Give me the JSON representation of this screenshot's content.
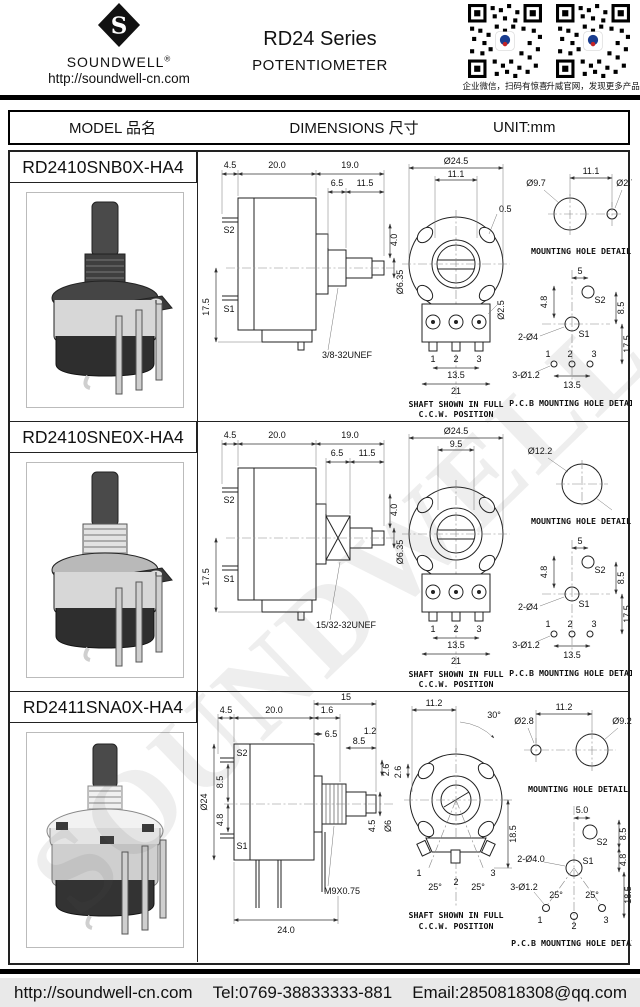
{
  "header": {
    "brand": "SOUNDWELL",
    "reg": "®",
    "site": "http://soundwell-cn.com",
    "title_line1": "RD24 Series",
    "title_line2": "POTENTIOMETER",
    "qr1_caption": "企业微信，扫码有惊喜",
    "qr2_caption": "升威官网，发现更多产品"
  },
  "table_header": {
    "model": "MODEL 品名",
    "dimensions": "DIMENSIONS 尺寸",
    "unit": "UNIT:mm"
  },
  "watermark": "SOUNDWELL",
  "rows": [
    {
      "model": "RD2410SNB0X-HA4",
      "side": {
        "a45": "4.5",
        "a200": "20.0",
        "a190": "19.0",
        "a65": "6.5",
        "a115": "11.5",
        "a40": "4.0",
        "d635": "Ø6.35",
        "s2": "S2",
        "s1": "S1",
        "a175": "17.5",
        "thread": "3/8-32UNEF"
      },
      "front": {
        "dia": "Ø24.5",
        "slot": "11.1",
        "a05": "0.5",
        "d25": "Ø2.5",
        "p1": "1",
        "p2": "2",
        "p3": "3",
        "a135": "13.5",
        "a21": "21",
        "cap1": "SHAFT SHOWN IN FULL",
        "cap2": "C.C.W. POSITION"
      },
      "mount": {
        "d1": "Ø9.7",
        "span": "11.1",
        "d2": "Ø2.7",
        "cap": "MOUNTING HOLE DETAIL"
      },
      "pcb": {
        "a5": "5",
        "a48": "4.8",
        "a85": "8.5",
        "a175": "17.5",
        "s2": "S2",
        "s1": "S1",
        "holes": "2-Ø4",
        "pins": "3-Ø1.2",
        "a135": "13.5",
        "p1": "1",
        "p2": "2",
        "p3": "3",
        "cap": "P.C.B MOUNTING HOLE DETAIL"
      }
    },
    {
      "model": "RD2410SNE0X-HA4",
      "side": {
        "a45": "4.5",
        "a200": "20.0",
        "a190": "19.0",
        "a65": "6.5",
        "a115": "11.5",
        "a40": "4.0",
        "d635": "Ø6.35",
        "s2": "S2",
        "s1": "S1",
        "a175": "17.5",
        "thread": "15/32-32UNEF"
      },
      "front": {
        "dia": "Ø24.5",
        "slot": "9.5",
        "p1": "1",
        "p2": "2",
        "p3": "3",
        "a135": "13.5",
        "a21": "21",
        "cap1": "SHAFT SHOWN IN FULL",
        "cap2": "C.C.W. POSITION"
      },
      "mount": {
        "d1": "Ø12.2",
        "cap": "MOUNTING HOLE DETAIL"
      },
      "pcb": {
        "a5": "5",
        "a48": "4.8",
        "a85": "8.5",
        "a175": "17.5",
        "s2": "S2",
        "s1": "S1",
        "holes": "2-Ø4",
        "pins": "3-Ø1.2",
        "a135": "13.5",
        "p1": "1",
        "p2": "2",
        "p3": "3",
        "cap": "P.C.B MOUNTING HOLE DETAIL"
      }
    },
    {
      "model": "RD2411SNA0X-HA4",
      "side": {
        "a15": "15",
        "a45": "4.5",
        "a200": "20.0",
        "a65": "6.5",
        "a16": "1.6",
        "a12": "1.2",
        "a85t": "8.5",
        "a26": "2.6",
        "dia": "Ø24",
        "a85l": "8.5",
        "a48l": "4.8",
        "s2": "S2",
        "s1": "S1",
        "a45r": "4.5",
        "d6": "Ø6",
        "thread": "M9X0.75",
        "a24": "24.0"
      },
      "front": {
        "a112": "11.2",
        "a30": "30°",
        "a26": "2.6",
        "a185": "18.5",
        "p1": "1",
        "p2": "2",
        "p3": "3",
        "a25l": "25°",
        "a25r": "25°",
        "cap1": "SHAFT SHOWN IN FULL",
        "cap2": "C.C.W. POSITION"
      },
      "mount": {
        "d1": "Ø2.8",
        "span": "11.2",
        "d2": "Ø9.2",
        "cap": "MOUNTING HOLE DETAIL"
      },
      "pcb": {
        "a50": "5.0",
        "s2": "S2",
        "a85": "8.5",
        "a48": "4.8",
        "holes": "2-Ø4.0",
        "s1": "S1",
        "pins": "3-Ø1.2",
        "a25l": "25°",
        "a25r": "25°",
        "a185": "18.5",
        "p1": "1",
        "p2": "2",
        "p3": "3",
        "cap": "P.C.B MOUNTING HOLE DETAIL"
      }
    }
  ],
  "footer": {
    "site": "http://soundwell-cn.com",
    "tel": "Tel:0769-38833333-881",
    "email": "Email:2850818308@qq.com"
  }
}
